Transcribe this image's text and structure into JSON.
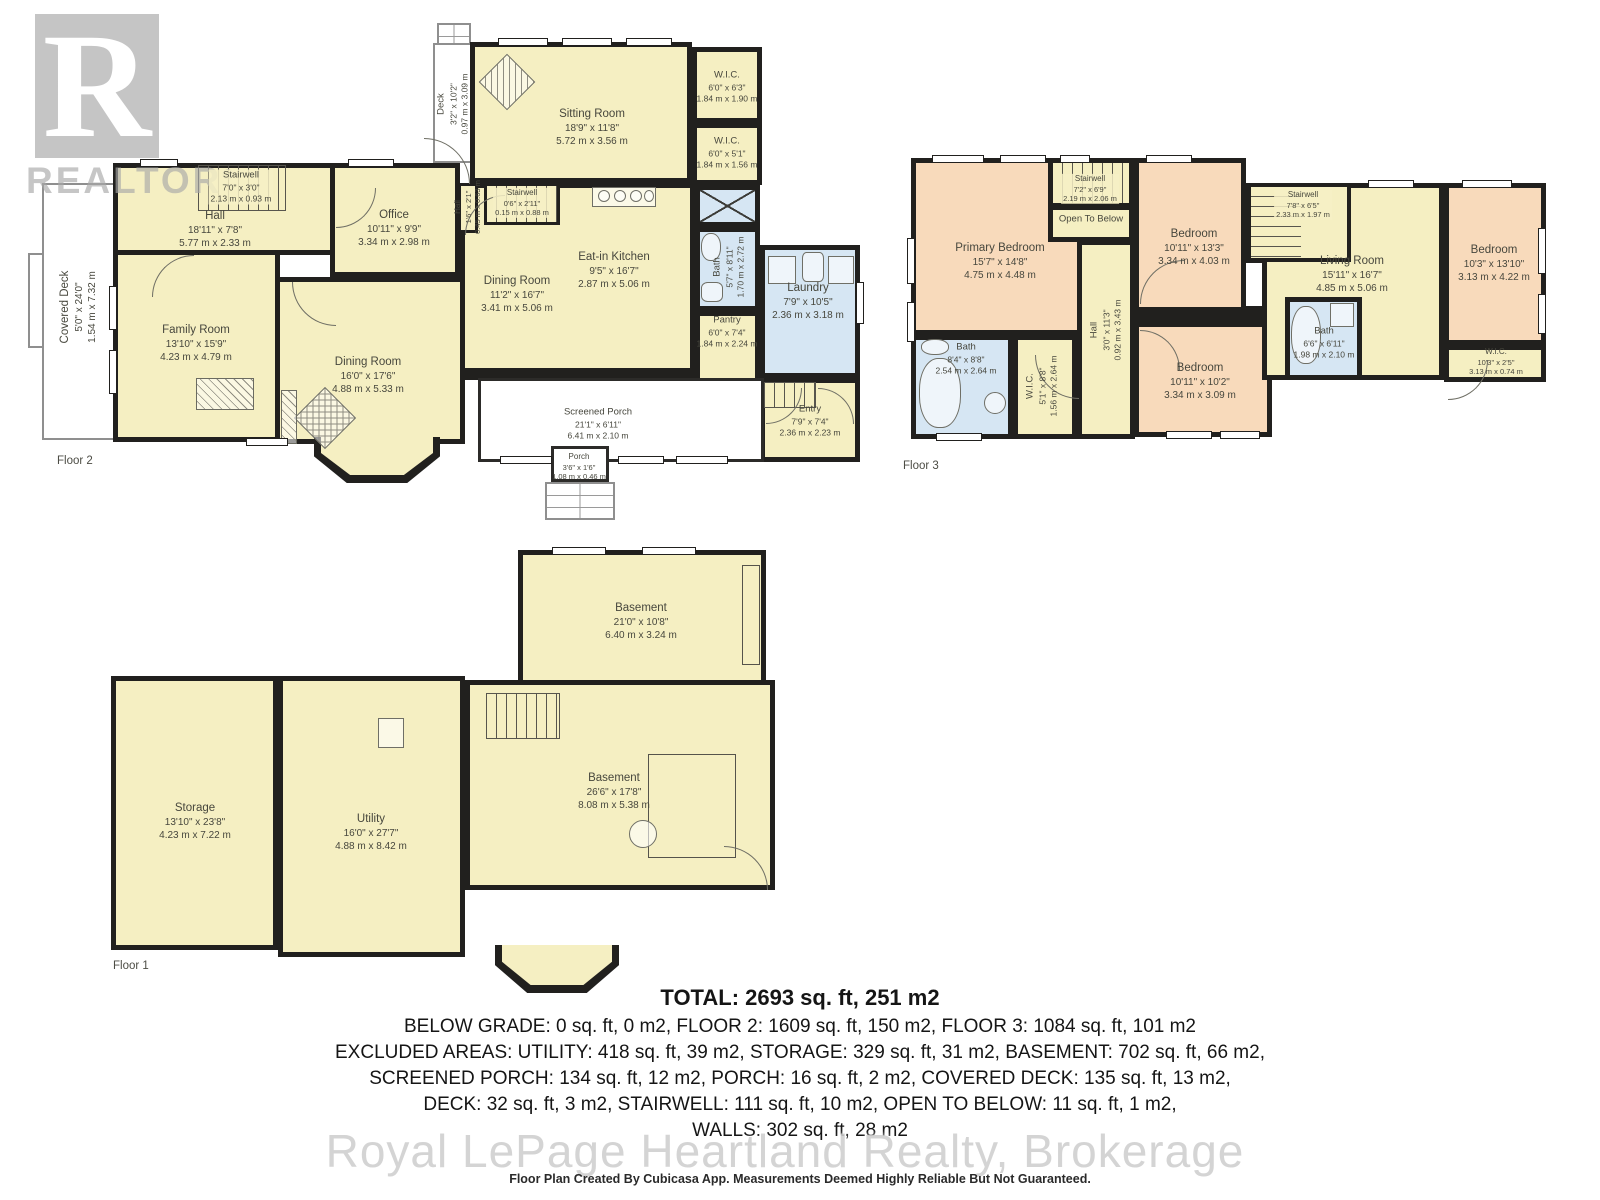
{
  "watermarks": {
    "realtor_letter": "R",
    "realtor_text": "REALTOR",
    "registered_mark": "®",
    "brokerage_text": "Royal LePage Heartland Realty, Brokerage"
  },
  "floors": {
    "f2": {
      "label": "Floor 2",
      "rooms": {
        "covered_deck": {
          "name": "Covered Deck",
          "ft": "5'0\" x 24'0\"",
          "m": "1.54 m x 7.32 m"
        },
        "deck": {
          "name": "Deck",
          "ft": "3'2\" x 10'2\"",
          "m": "0.97 m x 3.09 m"
        },
        "stairwell": {
          "name": "Stairwell",
          "ft": "7'0\" x 3'0\"",
          "m": "2.13 m x 0.93 m"
        },
        "hall": {
          "name": "Hall",
          "ft": "18'11\" x 7'8\"",
          "m": "5.77 m x 2.33 m"
        },
        "office": {
          "name": "Office",
          "ft": "10'11\" x 9'9\"",
          "m": "3.34 m x 2.98 m"
        },
        "sitting_room": {
          "name": "Sitting Room",
          "ft": "18'9\" x 11'8\"",
          "m": "5.72 m x 3.56 m"
        },
        "wic_1": {
          "name": "W.I.C.",
          "ft": "6'0\" x 6'3\"",
          "m": "1.84 m x 1.90 m"
        },
        "wic_2": {
          "name": "W.I.C.",
          "ft": "6'0\" x 5'1\"",
          "m": "1.84 m x 1.56 m"
        },
        "hall_small": {
          "name": "Hall",
          "ft": "1'6\" x 2'1\"",
          "m": "0.45 m x 0.63 m"
        },
        "stairwell_small": {
          "name": "Stairwell",
          "ft": "0'6\" x 2'11\"",
          "m": "0.15 m x 0.88 m"
        },
        "eat_in_kitchen": {
          "name": "Eat-in Kitchen",
          "ft": "9'5\" x 16'7\"",
          "m": "2.87 m x 5.06 m"
        },
        "dining_small": {
          "name": "Dining Room",
          "ft": "11'2\" x 16'7\"",
          "m": "3.41 m x 5.06 m"
        },
        "bath": {
          "name": "Bath",
          "ft": "5'7\" x 8'11\"",
          "m": "1.70 m x 2.72 m"
        },
        "laundry": {
          "name": "Laundry",
          "ft": "7'9\" x 10'5\"",
          "m": "2.36 m x 3.18 m"
        },
        "pantry": {
          "name": "Pantry",
          "ft": "6'0\" x 7'4\"",
          "m": "1.84 m x 2.24 m"
        },
        "family_room": {
          "name": "Family Room",
          "ft": "13'10\" x 15'9\"",
          "m": "4.23 m x 4.79 m"
        },
        "dining_big": {
          "name": "Dining Room",
          "ft": "16'0\" x 17'6\"",
          "m": "4.88 m x 5.33 m"
        },
        "screened_porch": {
          "name": "Screened Porch",
          "ft": "21'1\" x 6'11\"",
          "m": "6.41 m x 2.10 m"
        },
        "porch": {
          "name": "Porch",
          "ft": "3'6\" x 1'6\"",
          "m": "1.08 m x 0.46 m"
        },
        "entry": {
          "name": "Entry",
          "ft": "7'9\" x 7'4\"",
          "m": "2.36 m x 2.23 m"
        }
      }
    },
    "f3": {
      "label": "Floor 3",
      "rooms": {
        "primary_bedroom": {
          "name": "Primary Bedroom",
          "ft": "15'7\" x 14'8\"",
          "m": "4.75 m x 4.48 m"
        },
        "stairwell_top": {
          "name": "Stairwell",
          "ft": "7'2\" x 6'9\"",
          "m": "2.19 m x 2.06 m"
        },
        "open_to_below": {
          "name": "Open To Below"
        },
        "bedroom_top": {
          "name": "Bedroom",
          "ft": "10'11\" x 13'3\"",
          "m": "3.34 m x 4.03 m"
        },
        "stairwell_right": {
          "name": "Stairwell",
          "ft": "7'8\" x 6'5\"",
          "m": "2.33 m x 1.97 m"
        },
        "living_room": {
          "name": "Living Room",
          "ft": "15'11\" x 16'7\"",
          "m": "4.85 m x 5.06 m"
        },
        "bedroom_right": {
          "name": "Bedroom",
          "ft": "10'3\" x 13'10\"",
          "m": "3.13 m x 4.22 m"
        },
        "wic_right": {
          "name": "W.I.C.",
          "ft": "10'3\" x 2'5\"",
          "m": "3.13 m x 0.74 m"
        },
        "bath_right": {
          "name": "Bath",
          "ft": "6'6\" x 6'11\"",
          "m": "1.98 m x 2.10 m"
        },
        "hall": {
          "name": "Hall",
          "ft": "3'0\" x 11'3\"",
          "m": "0.92 m x 3.43 m"
        },
        "bath_left": {
          "name": "Bath",
          "ft": "8'4\" x 8'8\"",
          "m": "2.54 m x 2.64 m"
        },
        "wic_left": {
          "name": "W.I.C.",
          "ft": "5'1\" x 8'8\"",
          "m": "1.56 m x 2.64 m"
        },
        "bedroom_bottom": {
          "name": "Bedroom",
          "ft": "10'11\" x 10'2\"",
          "m": "3.34 m x 3.09 m"
        }
      }
    },
    "f1": {
      "label": "Floor 1",
      "rooms": {
        "basement_top": {
          "name": "Basement",
          "ft": "21'0\" x 10'8\"",
          "m": "6.40 m x 3.24 m"
        },
        "storage": {
          "name": "Storage",
          "ft": "13'10\" x 23'8\"",
          "m": "4.23 m x 7.22 m"
        },
        "utility": {
          "name": "Utility",
          "ft": "16'0\" x 27'7\"",
          "m": "4.88 m x 8.42 m"
        },
        "basement_main": {
          "name": "Basement",
          "ft": "26'6\" x 17'8\"",
          "m": "8.08 m x 5.38 m"
        }
      }
    }
  },
  "summary": {
    "total": "TOTAL: 2693 sq. ft, 251 m2",
    "lines": [
      "BELOW GRADE: 0 sq. ft, 0 m2, FLOOR 2: 1609 sq. ft, 150 m2, FLOOR 3: 1084 sq. ft, 101 m2",
      "EXCLUDED AREAS: UTILITY: 418 sq. ft, 39 m2, STORAGE: 329 sq. ft, 31 m2, BASEMENT: 702 sq. ft, 66 m2,",
      "SCREENED PORCH: 134 sq. ft, 12 m2, PORCH: 16 sq. ft, 2 m2, COVERED DECK: 135 sq. ft, 13 m2,",
      "DECK: 32 sq. ft, 3 m2, STAIRWELL: 111 sq. ft, 10 m2, OPEN TO BELOW: 11 sq. ft, 1 m2,",
      "WALLS: 302 sq. ft, 28 m2"
    ],
    "disclaimer": "Floor Plan Created By Cubicasa App. Measurements Deemed Highly Reliable But Not Guaranteed."
  },
  "colors": {
    "wall": "#21201e",
    "room_yellow": "#f5efc2",
    "room_peach": "#f8dabb",
    "room_blue": "#d6e6f3",
    "watermark_gray": "#c9c9c9"
  }
}
